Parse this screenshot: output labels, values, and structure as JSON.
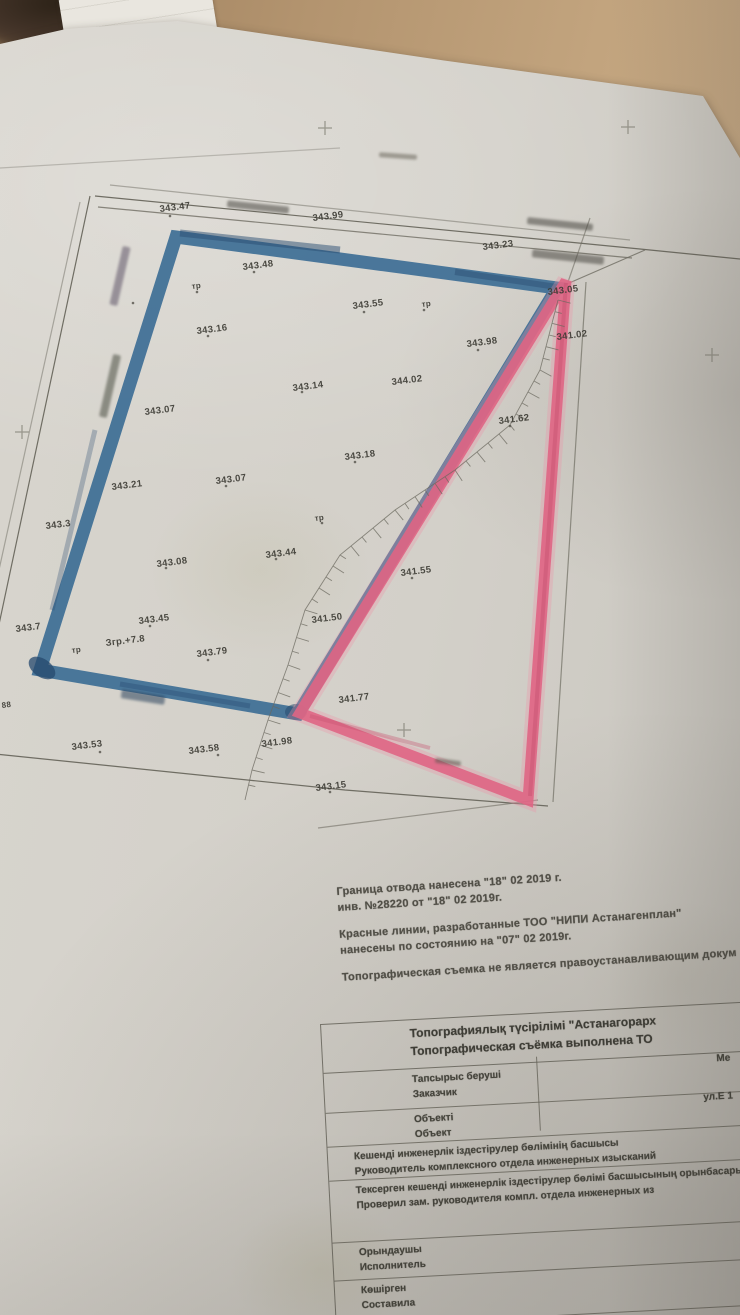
{
  "photo": {
    "scene": "photo of a topographic survey sheet on a wooden table",
    "wood_color": "#b2936f",
    "paper_color": "#d3d0c9"
  },
  "plan": {
    "allotment_boundary_color": "#3a6b94",
    "red_line_color": "#df6584",
    "labels": [
      {
        "t": "343.47",
        "x": 160,
        "y": 212
      },
      {
        "t": "343.99",
        "x": 313,
        "y": 221
      },
      {
        "t": "343.23",
        "x": 483,
        "y": 250
      },
      {
        "t": "343.48",
        "x": 243,
        "y": 270
      },
      {
        "t": "343.05",
        "x": 548,
        "y": 295
      },
      {
        "t": "тр",
        "x": 192,
        "y": 289
      },
      {
        "t": "343.55",
        "x": 353,
        "y": 309
      },
      {
        "t": "тр",
        "x": 422,
        "y": 307
      },
      {
        "t": "343.16",
        "x": 197,
        "y": 334
      },
      {
        "t": "343.98",
        "x": 467,
        "y": 347
      },
      {
        "t": "341.02",
        "x": 557,
        "y": 340
      },
      {
        "t": "343.14",
        "x": 293,
        "y": 391
      },
      {
        "t": "344.02",
        "x": 392,
        "y": 385
      },
      {
        "t": "341.62",
        "x": 499,
        "y": 424
      },
      {
        "t": "343.07",
        "x": 145,
        "y": 415
      },
      {
        "t": "343.18",
        "x": 345,
        "y": 460
      },
      {
        "t": "343.21",
        "x": 112,
        "y": 490
      },
      {
        "t": "343.07",
        "x": 216,
        "y": 484
      },
      {
        "t": "тр",
        "x": 315,
        "y": 521
      },
      {
        "t": "343.3",
        "x": 46,
        "y": 529
      },
      {
        "t": "343.08",
        "x": 157,
        "y": 567
      },
      {
        "t": "343.44",
        "x": 266,
        "y": 558
      },
      {
        "t": "341.55",
        "x": 401,
        "y": 576
      },
      {
        "t": "341.50",
        "x": 312,
        "y": 623
      },
      {
        "t": "343.45",
        "x": 139,
        "y": 624
      },
      {
        "t": "Згр.+7.8",
        "x": 106,
        "y": 646
      },
      {
        "t": "тр",
        "x": 72,
        "y": 653
      },
      {
        "t": "343.79",
        "x": 197,
        "y": 657
      },
      {
        "t": "343.7",
        "x": 16,
        "y": 632
      },
      {
        "t": "88",
        "x": 2,
        "y": 708
      },
      {
        "t": "341.98",
        "x": 262,
        "y": 747
      },
      {
        "t": "341.77",
        "x": 339,
        "y": 703
      },
      {
        "t": "343.53",
        "x": 72,
        "y": 750
      },
      {
        "t": "343.58",
        "x": 189,
        "y": 754
      },
      {
        "t": "343.15",
        "x": 316,
        "y": 791
      }
    ],
    "smudges": [
      {
        "x": 258,
        "y": 207,
        "w": 62,
        "h": 7,
        "r": 6,
        "c": "#4a4842"
      },
      {
        "x": 560,
        "y": 224,
        "w": 66,
        "h": 7,
        "r": 6,
        "c": "#4a4842"
      },
      {
        "x": 568,
        "y": 257,
        "w": 72,
        "h": 8,
        "r": 6,
        "c": "#4a4842"
      },
      {
        "x": 398,
        "y": 156,
        "w": 38,
        "h": 5,
        "r": 4,
        "c": "#6b675c"
      },
      {
        "x": 120,
        "y": 276,
        "w": 60,
        "h": 8,
        "r": 103,
        "c": "#5f5568"
      },
      {
        "x": 110,
        "y": 386,
        "w": 64,
        "h": 8,
        "r": 103,
        "c": "#4b4f43"
      },
      {
        "x": 143,
        "y": 697,
        "w": 44,
        "h": 9,
        "r": 9,
        "c": "#2d445e"
      },
      {
        "x": 448,
        "y": 762,
        "w": 26,
        "h": 5,
        "r": 8,
        "c": "#5a584e"
      }
    ]
  },
  "notes": {
    "lines": [
      "Граница отвода нанесена  \"18\"  02  2019 г.",
      "инв. №28220 от \"18\"  02  2019г.",
      "",
      "Красные линии, разработанные ТОО \"НИПИ Астанагенплан\"",
      "нанесены по состоянию на \"07\"  02  2019г.",
      "",
      "Топографическая съемка не является правоустанавливающим докум"
    ]
  },
  "table": {
    "header_kk": "Топографиялық түсірілімі  \"Астанагорарх",
    "header_ru": "Топографическая съёмка выполнена ТО",
    "fragment_scale": "Ме",
    "fragment_address": "ул.Е 1",
    "rows": [
      {
        "kk": "Тапсырыс беруші",
        "ru": "Заказчик"
      },
      {
        "kk": "Объекті",
        "ru": "Объект"
      },
      {
        "kk": "Кешенді инженерлік іздестірулер бөлімінің басшысы",
        "ru": "Руководитель комплексного отдела инженерных изысканий"
      },
      {
        "kk": "Тексерген кешенді инженерлік іздестірулер бөлімі басшысының орынбасары",
        "ru": "Проверил зам. руководителя компл. отдела инженерных из"
      },
      {
        "kk": "Орындаушы",
        "ru": "Исполнитель"
      },
      {
        "kk": "Көшірген",
        "ru": "Составила"
      }
    ]
  }
}
